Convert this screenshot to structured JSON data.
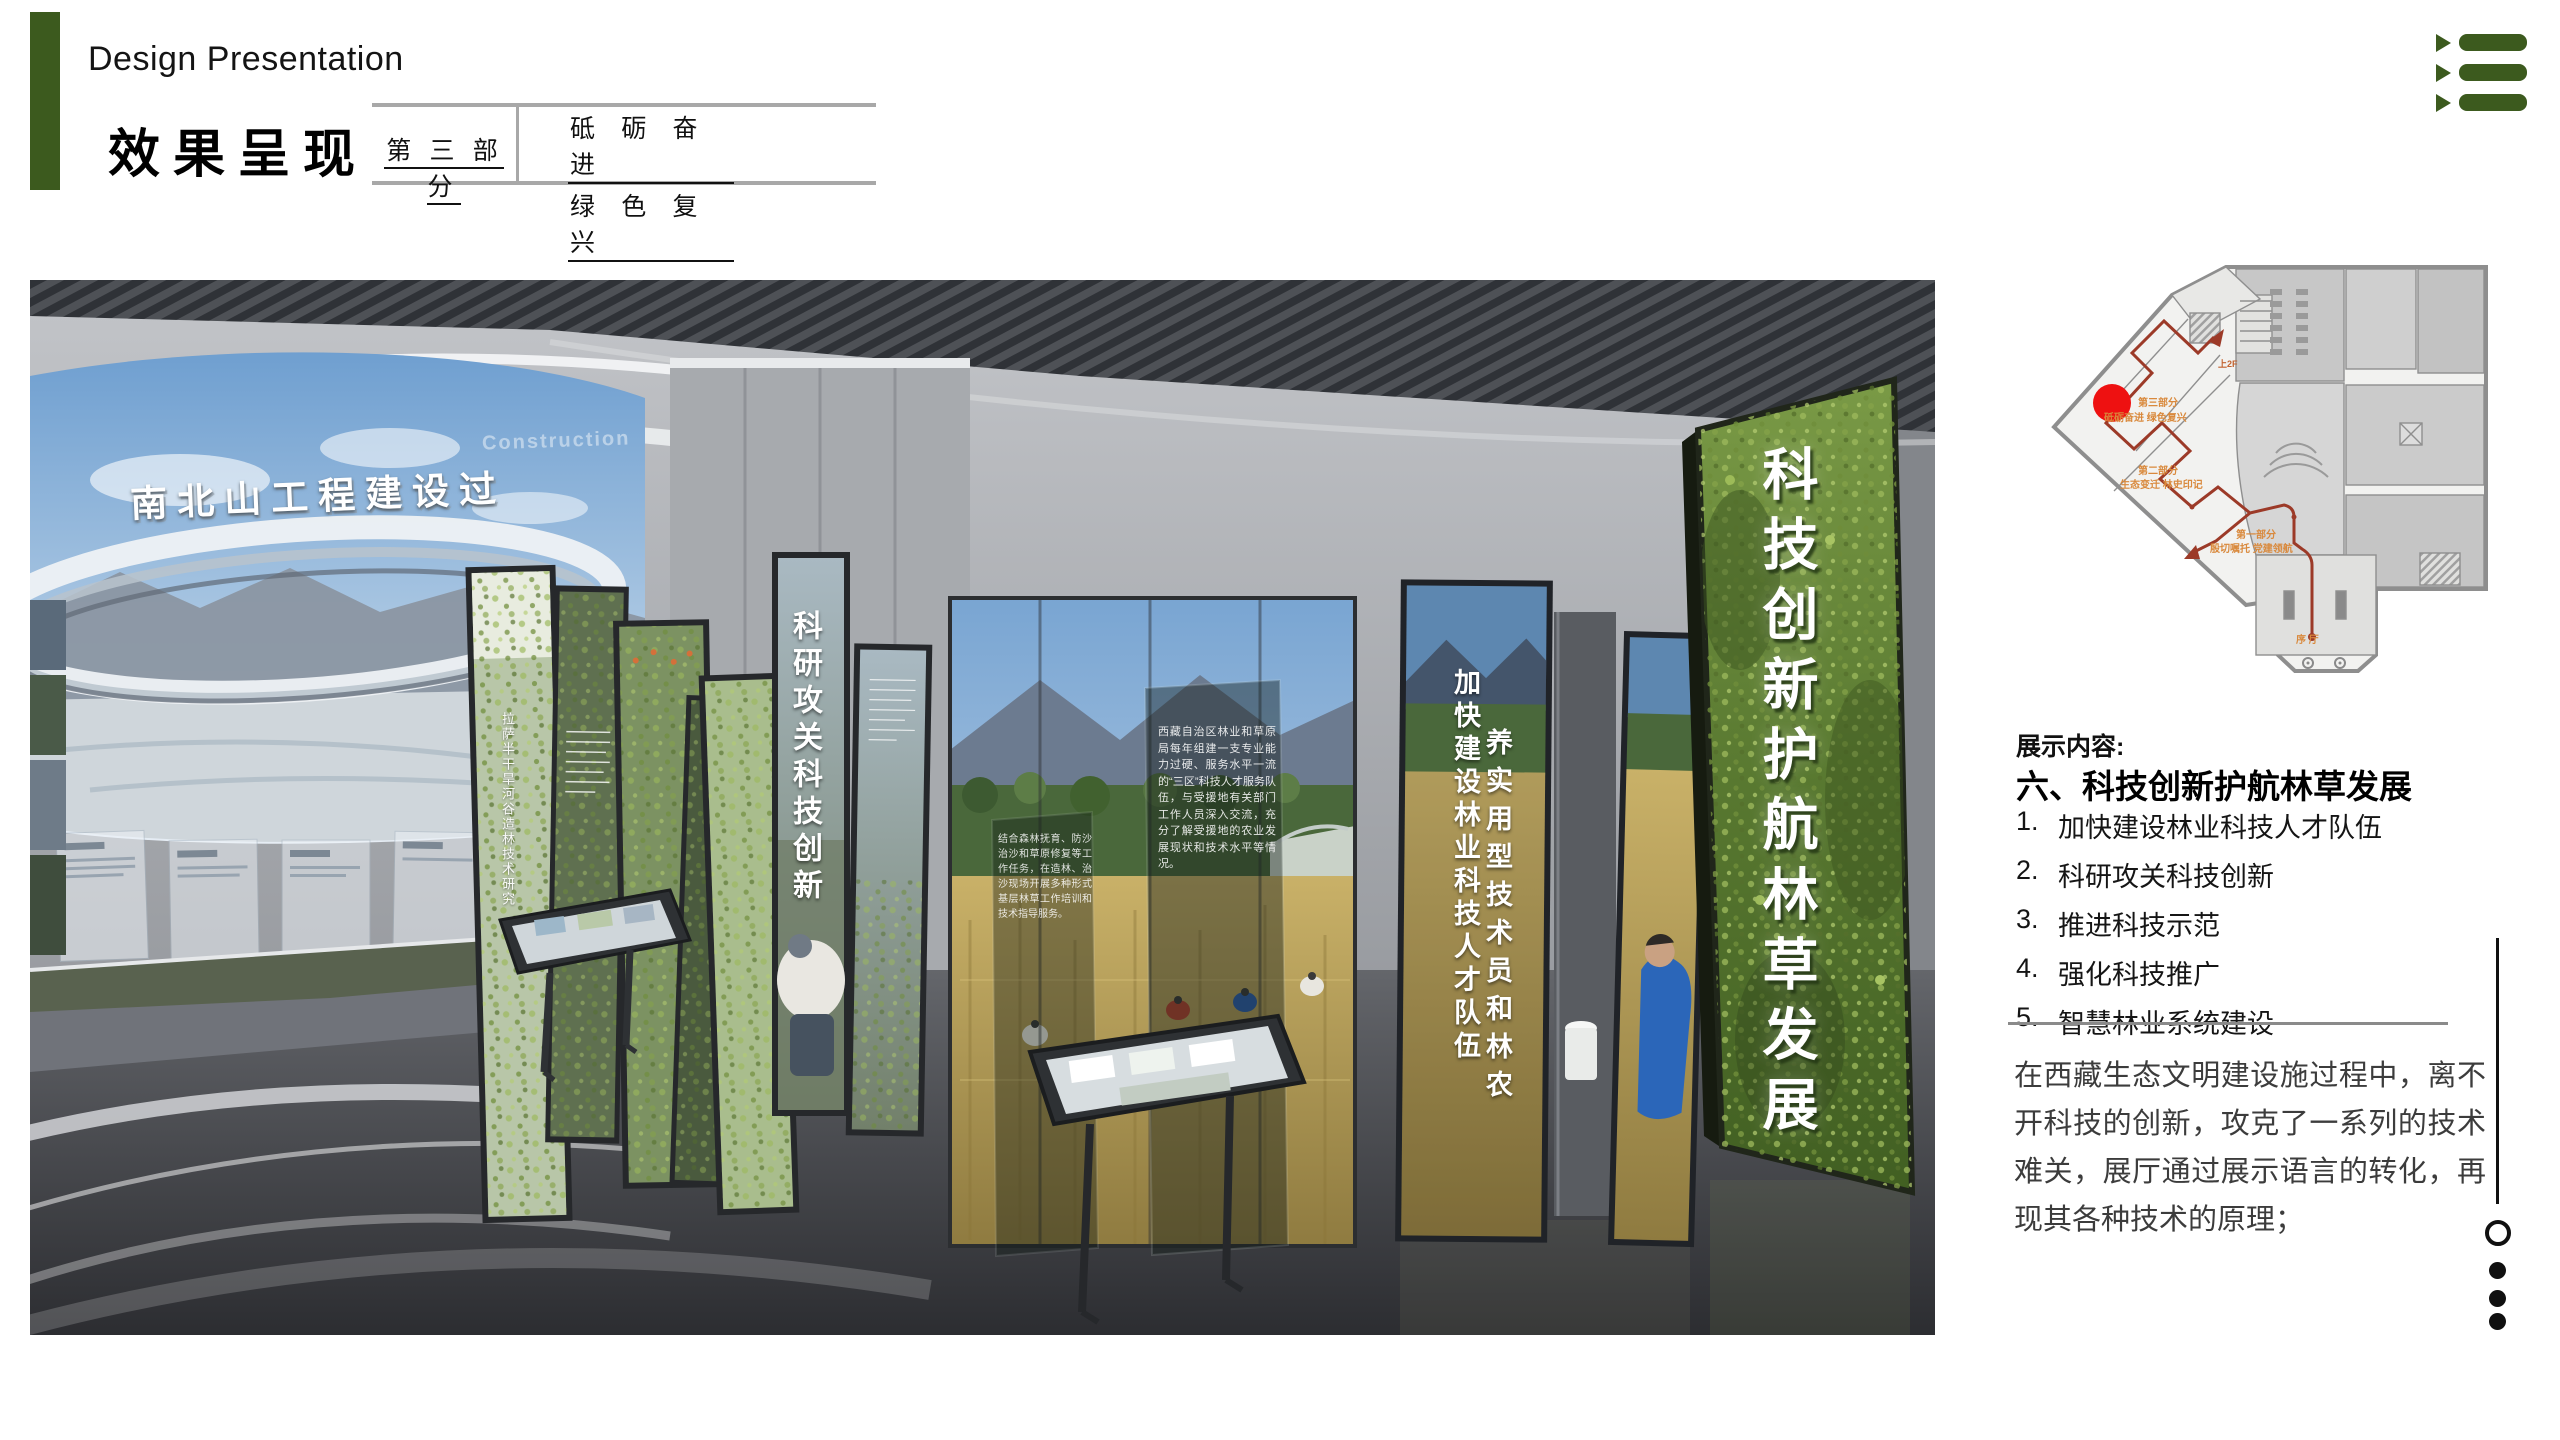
{
  "slide": {
    "title_en": "Design Presentation",
    "title_cn": "效果呈现",
    "accent_color": "#3c5a1e",
    "part_box": {
      "part_label": "第 三 部 分",
      "theme_line1": "砥 砺 奋 进",
      "theme_line2": "绿 色 复 兴"
    }
  },
  "nav_icon": {
    "name": "list-menu",
    "color": "#3c5a1e"
  },
  "floor_plan": {
    "marker_color": "#ee1111",
    "route_color": "#9c3a28",
    "label_color": "#d9893c",
    "labels": {
      "part3": "第三部分",
      "part3_sub": "砥砺奋进 绿色复兴",
      "part2": "第二部分",
      "part2_sub": "生态变迁 林史印记",
      "part1": "第一部分",
      "part1_sub": "殷切嘱托 党建领航",
      "lobby": "序 厅",
      "up_2f": "上2F"
    }
  },
  "content_panel": {
    "section_label": "展示内容:",
    "heading": "六、科技创新护航林草发展",
    "items": [
      {
        "num": "1.",
        "text": "加快建设林业科技人才队伍"
      },
      {
        "num": "2.",
        "text": "科研攻关科技创新"
      },
      {
        "num": "3.",
        "text": "推进科技示范"
      },
      {
        "num": "4.",
        "text": "强化科技推广"
      },
      {
        "num": "5.",
        "text": "智慧林业系统建设"
      }
    ],
    "paragraph": "在西藏生态文明建设施过程中，离不开科技的创新，攻克了一系列的技术难关，展厅通过展示语言的转化，再现其各种技术的原理；"
  },
  "render": {
    "mural_title": "南北山工程建设过",
    "mural_caption": "Construction",
    "panel_note": "拉萨半干旱河谷造林技术研究",
    "banner_research": "科研攻关科技创新",
    "banner_talent": "加快建设林业科技人才队伍",
    "banner_training": "养实用型技术员和林农",
    "banner_main": "科技创新护航林草发展",
    "glass_text_right": "西藏自治区林业和草原局每年组建一支专业能力过硬、服务水平一流的“三区”科技人才服务队伍，与受援地有关部门工作人员深入交流，充分了解受援地的农业发展现状和技术水平等情况。",
    "glass_text_left": "结合森林抚育、防沙治沙和草原修复等工作任务，在造林、治沙现场开展多种形式基层林草工作培训和技术指导服务。"
  }
}
